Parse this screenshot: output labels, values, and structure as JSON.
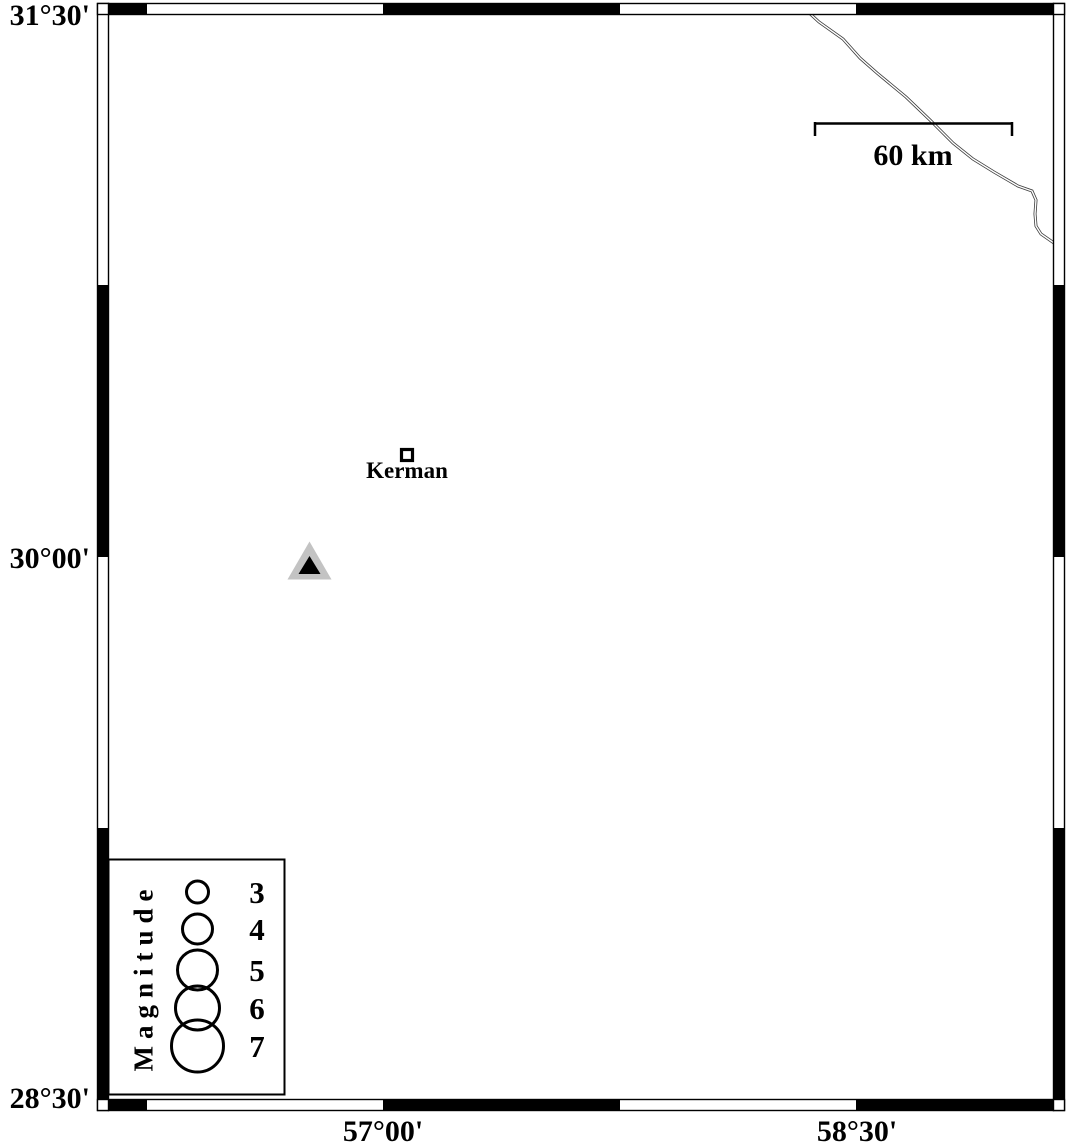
{
  "figure": {
    "type": "seismicity-station-map",
    "background": "#ffffff"
  },
  "axes": {
    "latitude_ticks": [
      "31°30'",
      "30°00'",
      "28°30'"
    ],
    "longitude_ticks": [
      "57°00'",
      "58°30'"
    ]
  },
  "frame": {
    "style": "fancy-checkered",
    "color": "#000000"
  },
  "scale_bar": {
    "label": "60 km"
  },
  "city_marker": {
    "label": "Kerman",
    "symbol": "open-square"
  },
  "station_marker": {
    "symbol": "triangle",
    "outer_color": "#c3c3c3",
    "inner_color": "#000000"
  },
  "road": {
    "style": "double-line",
    "color": "#3d3d3d"
  },
  "legend": {
    "title": "Magnitude",
    "entries": [
      {
        "label": "3",
        "radius": 11
      },
      {
        "label": "4",
        "radius": 15
      },
      {
        "label": "5",
        "radius": 20
      },
      {
        "label": "6",
        "radius": 22
      },
      {
        "label": "7",
        "radius": 26
      }
    ]
  }
}
